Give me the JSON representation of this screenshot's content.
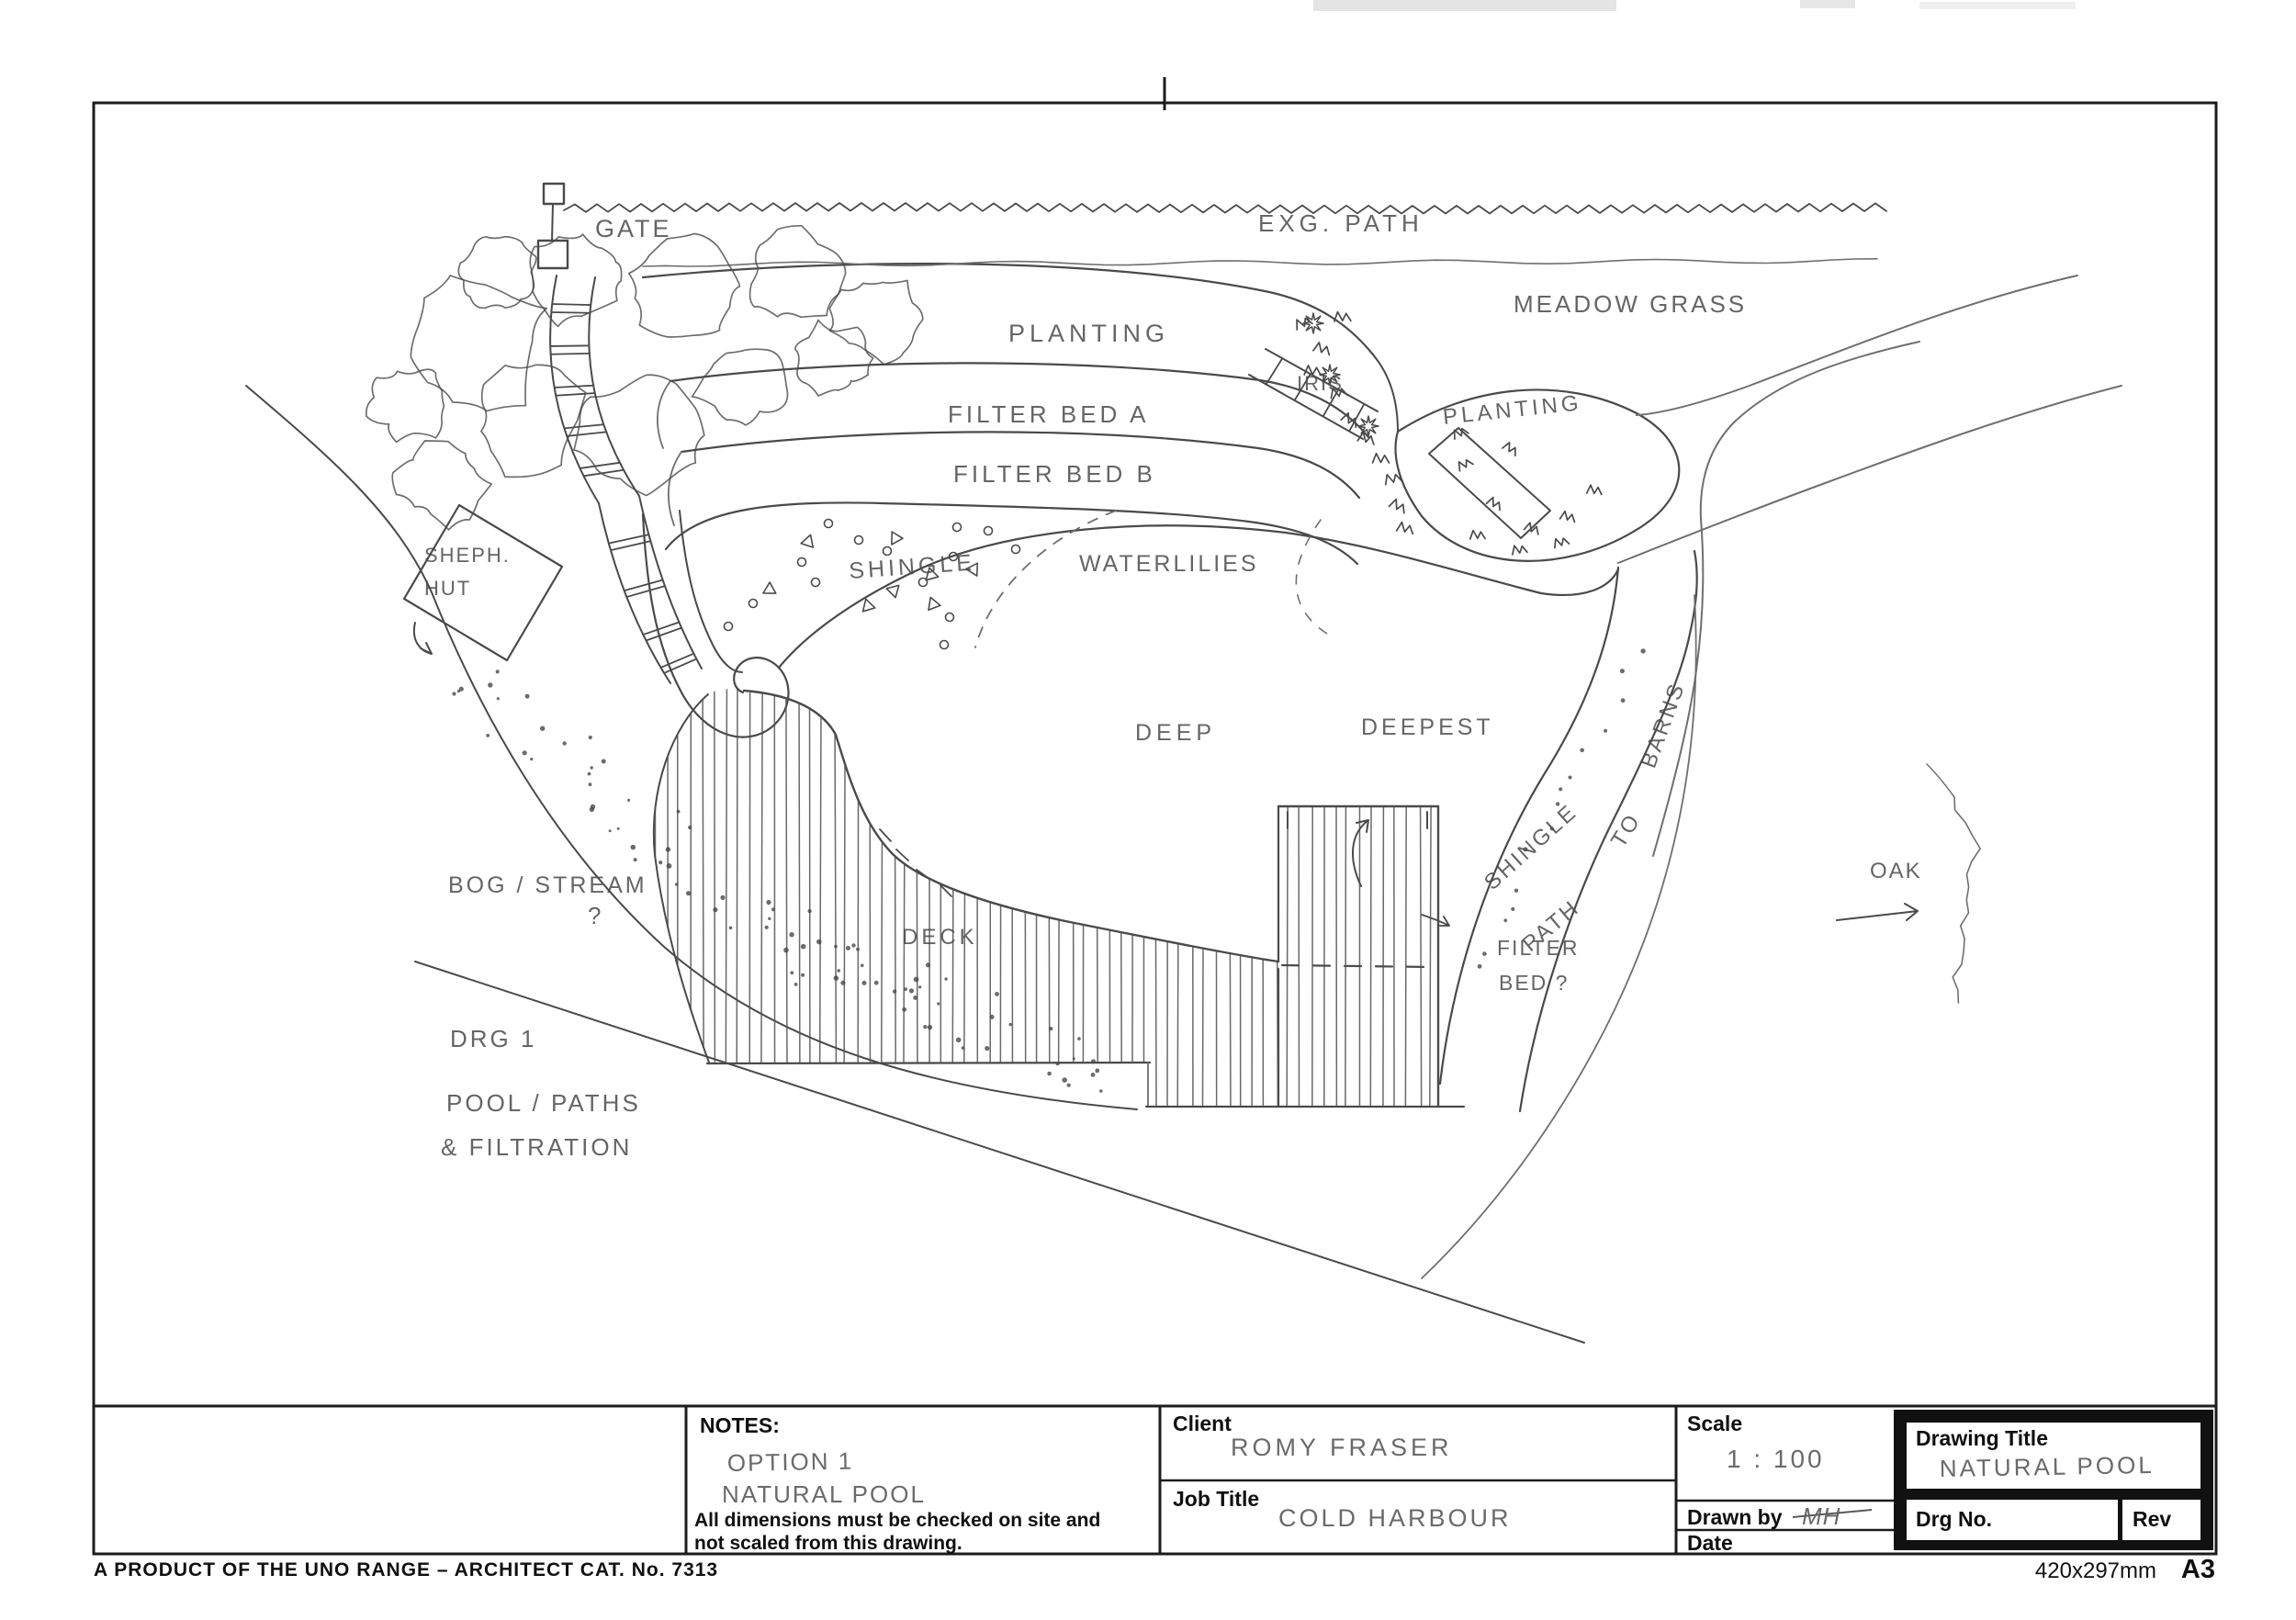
{
  "plan_labels": {
    "gate": "GATE",
    "exg_path": "EXG.  PATH",
    "meadow_grass": "MEADOW  GRASS",
    "planting_left": "PLANTING",
    "filter_bed_a": "FILTER BED  A",
    "filter_bed_b": "FILTER BED  B",
    "iris": "IRIS",
    "planting_right": "PLANTING",
    "sheph_line1": "SHEPH.",
    "sheph_line2": "HUT",
    "shingle_beach": "SHINGLE",
    "waterlilies": "WATERLILIES",
    "deep": "DEEP",
    "deepest": "DEEPEST",
    "shingle_path": "SHINGLE",
    "path_word": "PATH",
    "to_word": "TO",
    "barns_word": "BARNS",
    "bog_stream": "BOG / STREAM",
    "bog_q": "?",
    "deck": "DECK",
    "filter_q_line1": "FILTER",
    "filter_q_line2": "BED ?",
    "oak": "OAK",
    "drg1": "DRG 1",
    "pool_paths": "POOL / PATHS",
    "filtration": "& FILTRATION"
  },
  "title_block": {
    "notes_label": "NOTES:",
    "notes_line1": "OPTION 1",
    "notes_line2": "NATURAL POOL",
    "disclaimer_line1": "All dimensions must be checked on site and",
    "disclaimer_line2": "not scaled from this drawing.",
    "client_label": "Client",
    "client_value": "ROMY FRASER",
    "job_label": "Job Title",
    "job_value": "COLD HARBOUR",
    "scale_label": "Scale",
    "scale_value": "1 : 100",
    "drawn_by_label": "Drawn by",
    "drawn_by_value": "MH",
    "date_label": "Date",
    "drawing_title_label": "Drawing Title",
    "drawing_title_value": "NATURAL POOL",
    "drg_no_label": "Drg No.",
    "rev_label": "Rev"
  },
  "footer": {
    "product_note": "A PRODUCT OF THE UNO RANGE – ARCHITECT CAT. No. 7313",
    "paper_note": "420x297mm",
    "paper_format": "A3"
  }
}
